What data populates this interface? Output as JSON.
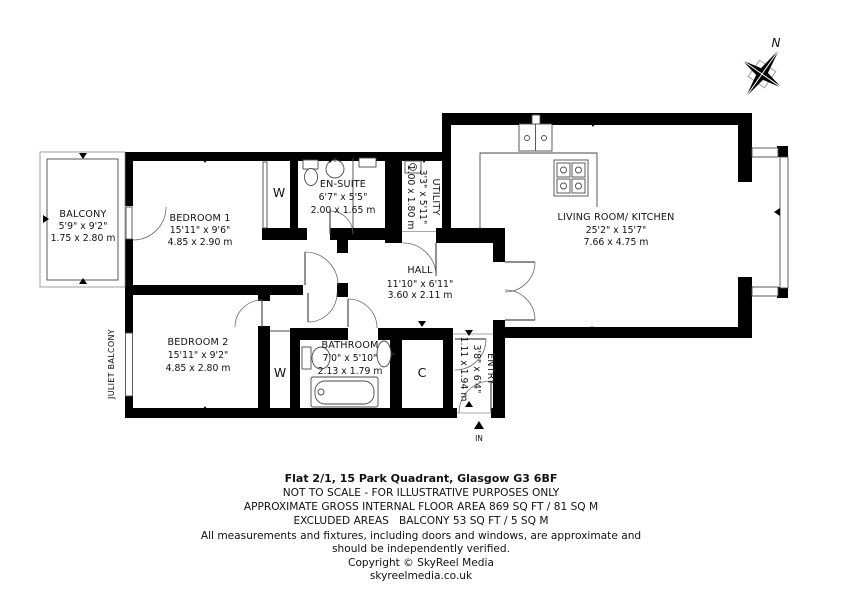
{
  "plan": {
    "rooms": {
      "balcony": {
        "name": "BALCONY",
        "imperial": "5'9\" x 9'2\"",
        "metric": "1.75 x 2.80 m"
      },
      "bedroom1": {
        "name": "BEDROOM 1",
        "imperial": "15'11\" x 9'6\"",
        "metric": "4.85 x 2.90 m"
      },
      "ensuite": {
        "name": "EN-SUITE",
        "imperial": "6'7\" x 5'5\"",
        "metric": "2.00 x 1.65 m"
      },
      "utility": {
        "name": "UTILITY",
        "imperial": "3'3\" x 5'11\"",
        "metric": "1.00 x 1.80 m"
      },
      "living": {
        "name": "LIVING ROOM/ KITCHEN",
        "imperial": "25'2\" x 15'7\"",
        "metric": "7.66 x 4.75 m"
      },
      "hall": {
        "name": "HALL",
        "imperial": "11'10\" x 6'11\"",
        "metric": "3.60 x 2.11 m"
      },
      "bedroom2": {
        "name": "BEDROOM 2",
        "imperial": "15'11\" x 9'2\"",
        "metric": "4.85 x 2.80 m"
      },
      "bathroom": {
        "name": "BATHROOM",
        "imperial": "7'0\" x 5'10\"",
        "metric": "2.13 x 1.79 m"
      },
      "entry": {
        "name": "ENTRY",
        "imperial": "3'8\" x 6'4\"",
        "metric": "1.11 x 1.94 m"
      }
    },
    "markers": {
      "wardrobe": "W",
      "cupboard": "C",
      "juliet_balcony": "JULIET BALCONY",
      "entrance": "IN",
      "north": "N"
    },
    "colors": {
      "wall": "#000000",
      "line": "#4a4a4a",
      "background": "#ffffff"
    }
  },
  "footer": {
    "address": "Flat 2/1, 15 Park Quadrant, Glasgow G3 6BF",
    "scale_note": "NOT TO SCALE - FOR ILLUSTRATIVE PURPOSES ONLY",
    "floor_area": "APPROXIMATE GROSS INTERNAL FLOOR AREA 869 SQ FT / 81 SQ M",
    "excluded_areas": "EXCLUDED AREAS   BALCONY 53 SQ FT / 5 SQ M",
    "disclaimer_line1": "All measurements and fixtures, including doors and windows, are approximate and",
    "disclaimer_line2": "should be independently verified.",
    "copyright": "Copyright © SkyReel Media",
    "website": "skyreelmedia.co.uk"
  }
}
